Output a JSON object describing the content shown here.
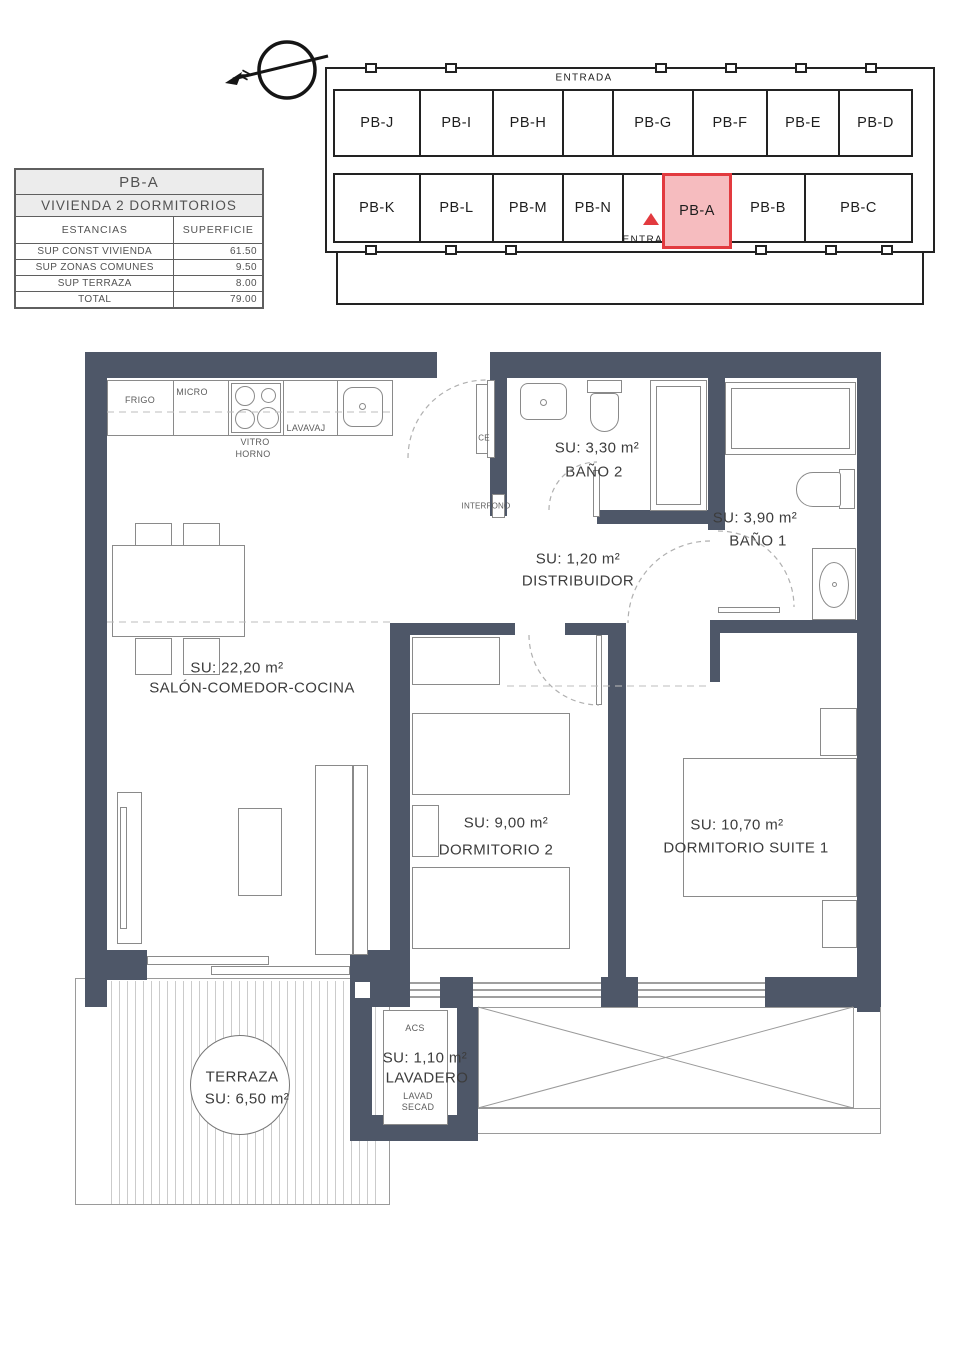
{
  "colors": {
    "wall": "#4e5768",
    "red": "#e23a3f",
    "redfill": "#f6bcbf"
  },
  "north": {
    "label": "N"
  },
  "info_table": {
    "title": "PB-A",
    "subtitle": "VIVIENDA 2 DORMITORIOS",
    "col_rooms": "ESTANCIAS",
    "col_area": "SUPERFICIE",
    "rows": [
      {
        "label": "SUP CONST VIVIENDA",
        "value": "61.50"
      },
      {
        "label": "SUP ZONAS COMUNES",
        "value": "9.50"
      },
      {
        "label": "SUP TERRAZA",
        "value": "8.00"
      },
      {
        "label": "TOTAL",
        "value": "79.00"
      }
    ]
  },
  "keyplan": {
    "entrada_top": "ENTRADA",
    "entrada_bottom": "ENTRADA",
    "highlighted": "PB-A",
    "top_row": [
      "PB-J",
      "PB-I",
      "PB-H",
      "PB-G",
      "PB-F",
      "PB-E",
      "PB-D"
    ],
    "bottom_row": [
      "PB-K",
      "PB-L",
      "PB-M",
      "PB-N",
      "PB-A",
      "PB-B",
      "PB-C"
    ]
  },
  "rooms": {
    "salon": {
      "area": "SU: 22,20 m²",
      "name": "SALÓN-COMEDOR-COCINA"
    },
    "bano2": {
      "area": "SU: 3,30 m²",
      "name": "BAÑO 2"
    },
    "bano1": {
      "area": "SU: 3,90 m²",
      "name": "BAÑO 1"
    },
    "distribuidor": {
      "area": "SU: 1,20 m²",
      "name": "DISTRIBUIDOR"
    },
    "dormitorio2": {
      "area": "SU: 9,00 m²",
      "name": "DORMITORIO 2"
    },
    "suite": {
      "area": "SU: 10,70 m²",
      "name": "DORMITORIO SUITE 1"
    },
    "terraza": {
      "name": "TERRAZA",
      "area": "SU: 6,50 m²"
    },
    "lavadero": {
      "area": "SU: 1,10 m²",
      "name": "LAVADERO"
    }
  },
  "fixtures": {
    "frigo": "FRIGO",
    "micro": "MICRO",
    "vitro": "VITRO",
    "horno": "HORNO",
    "lavavaj": "LAVAVAJ",
    "ce": "CE",
    "interfono": "INTERFONO",
    "acs": "ACS",
    "lavad": "LAVAD",
    "secad": "SECAD"
  }
}
